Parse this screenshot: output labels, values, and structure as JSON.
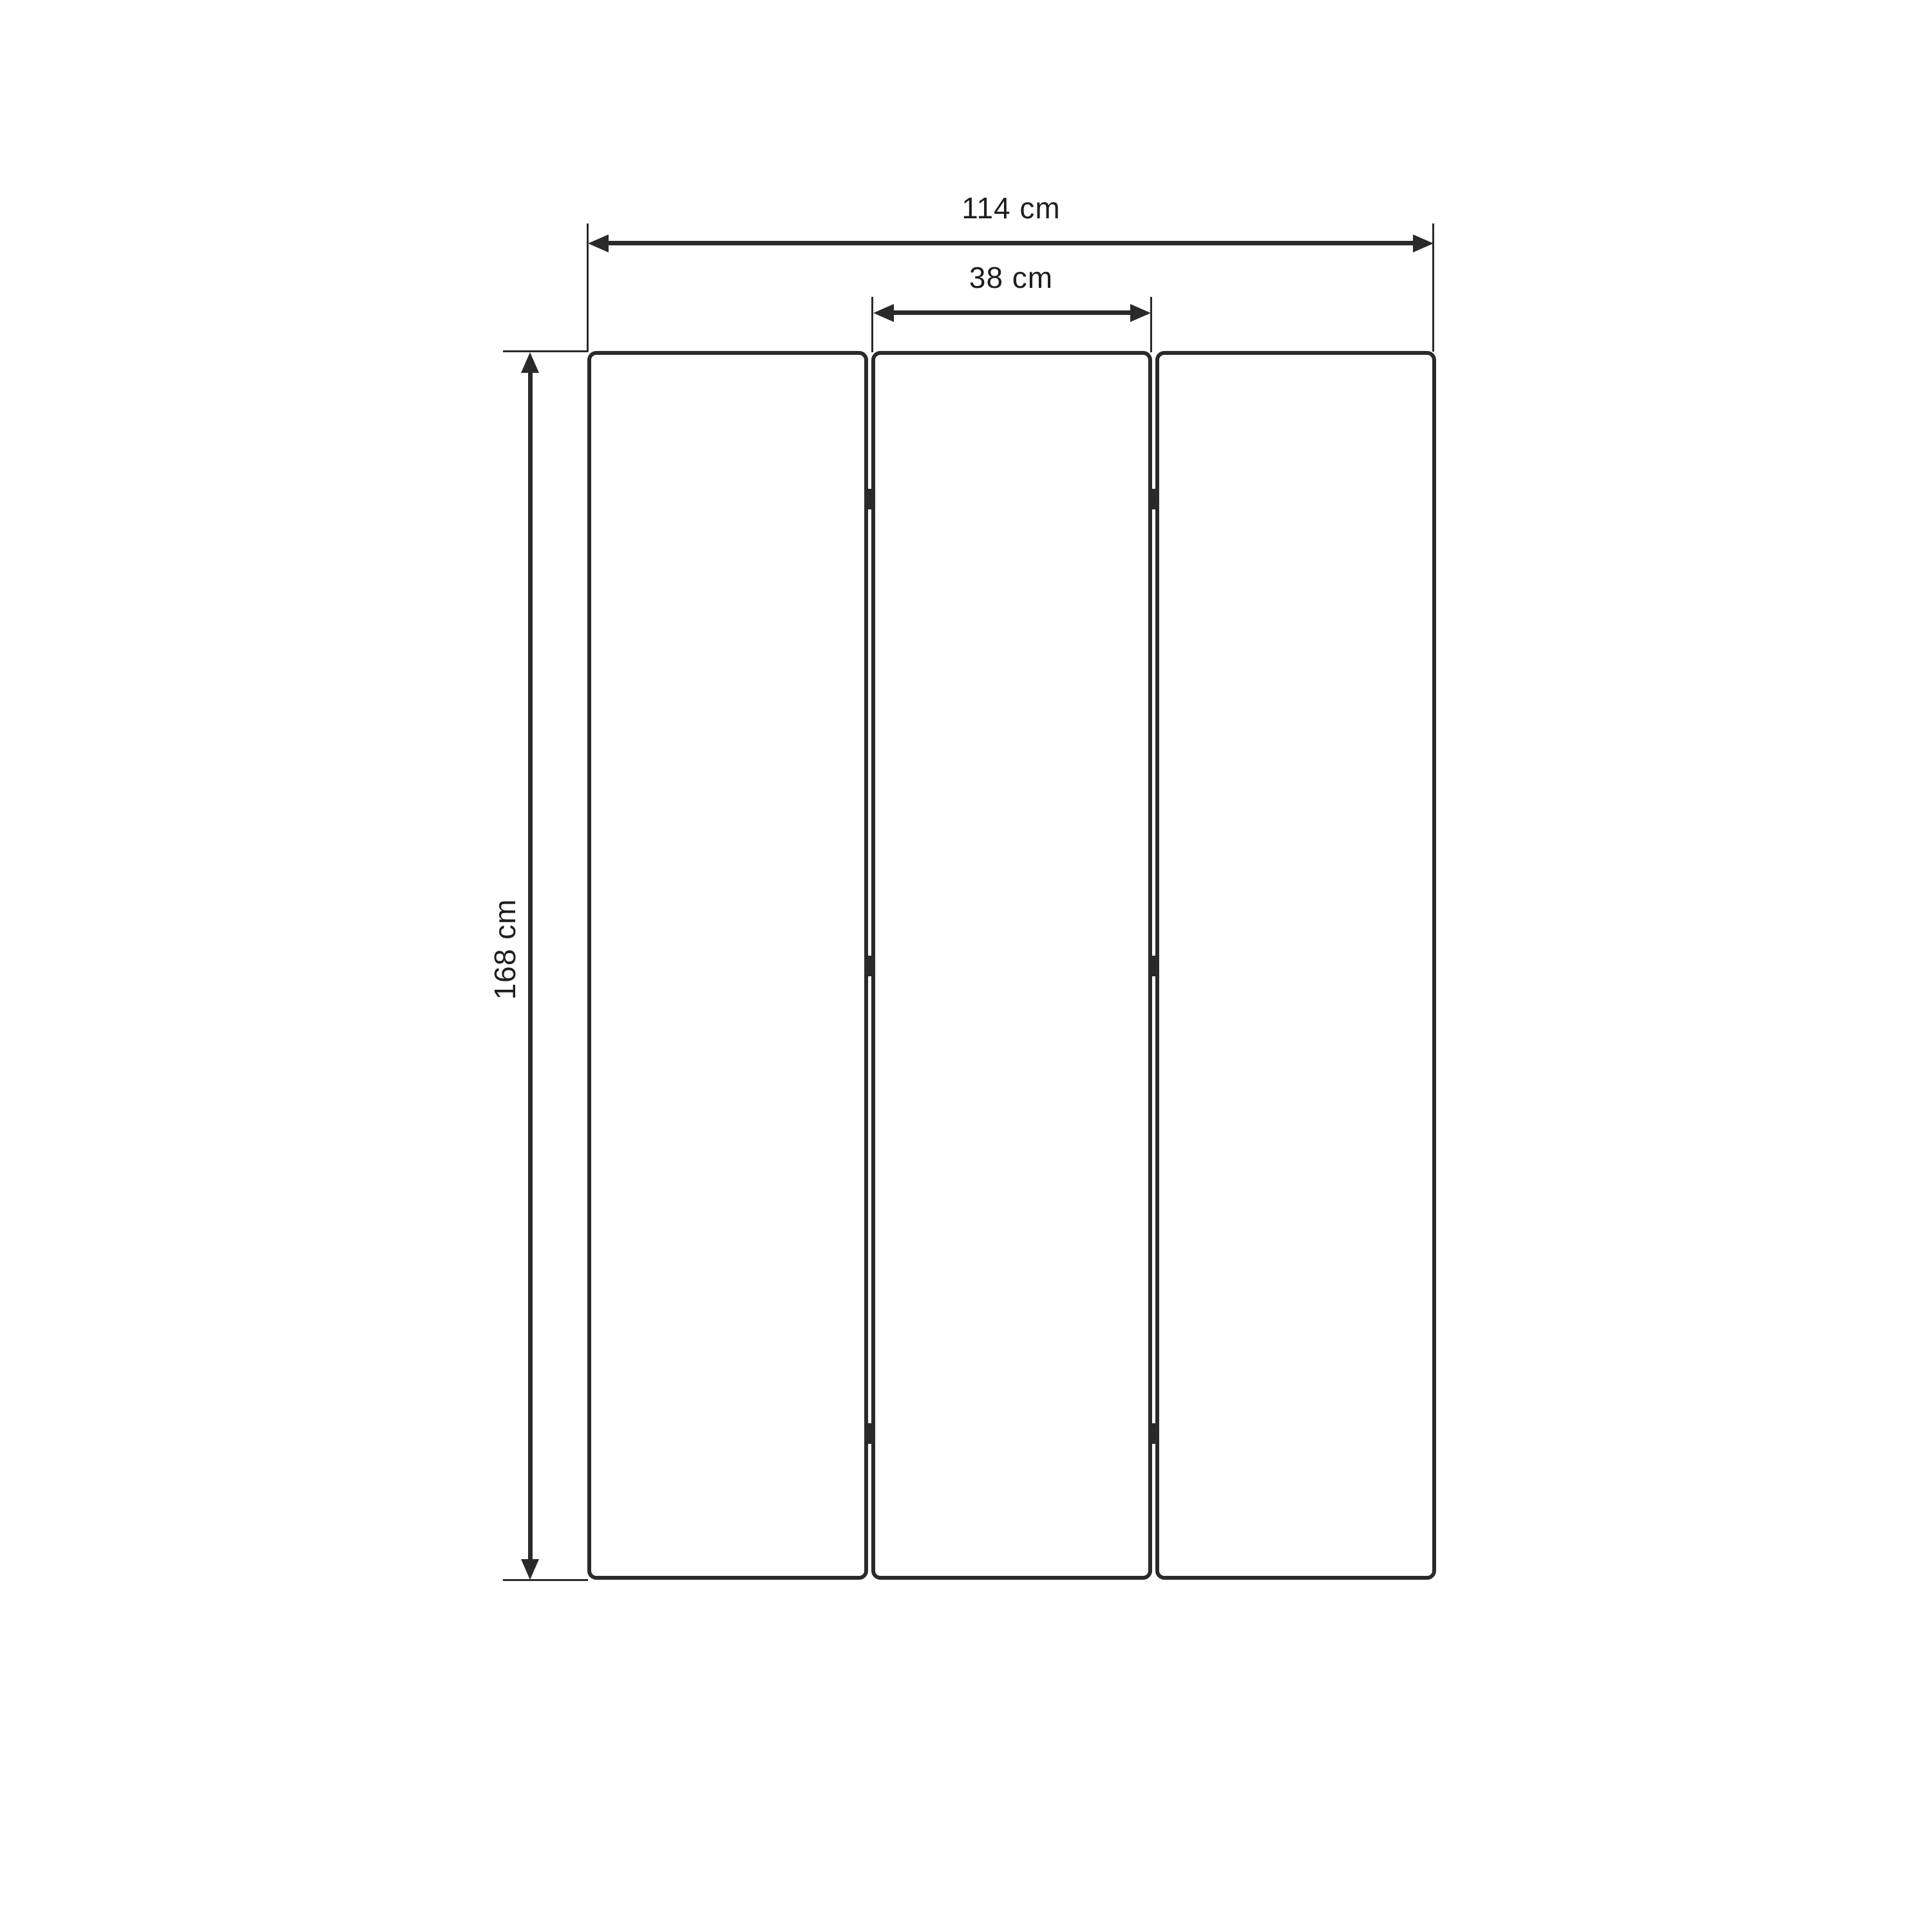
{
  "diagram": {
    "description": "three-panel-room-divider-dimension-drawing",
    "panel_count": 3,
    "dimensions": {
      "total_width": "114 cm",
      "panel_width": "38 cm",
      "height": "168 cm"
    },
    "colors": {
      "background": "#ffffff",
      "line": "#2a2a2a",
      "text": "#1e1e1e"
    }
  }
}
